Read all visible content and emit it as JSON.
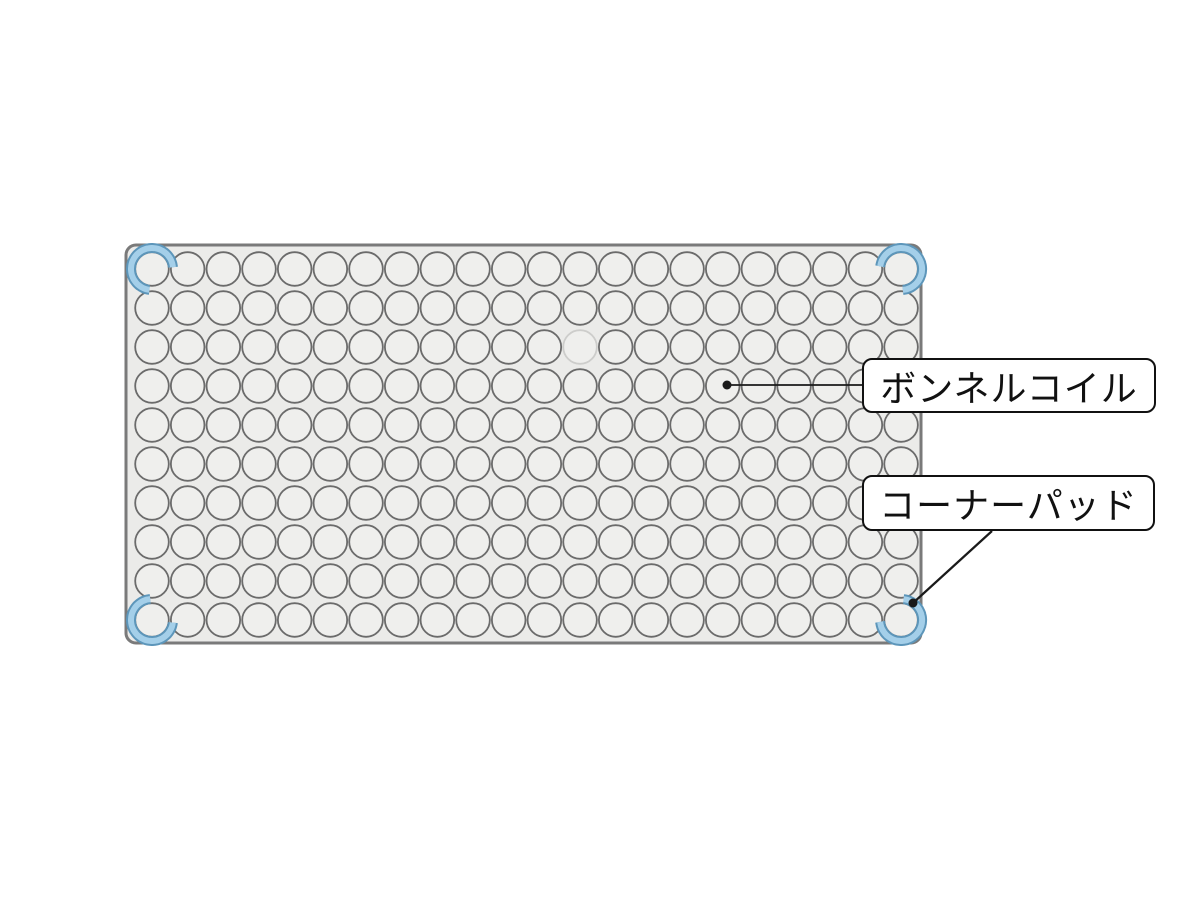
{
  "diagram": {
    "description": "mattress-bonnell-coil-structure-diagram",
    "mattress": {
      "x": 126,
      "y": 245,
      "width": 795,
      "height": 398,
      "corner_radius": 10,
      "fill": "#ebebe9",
      "stroke": "#7a7a7a",
      "stroke_width": 3
    },
    "coil_grid": {
      "rows": 10,
      "cols": 22,
      "start_x": 152,
      "start_y": 269,
      "pitch_x": 35.67,
      "pitch_y": 39,
      "radius": 16.8,
      "stroke": "#6b6b6b",
      "stroke_width": 1.8,
      "fill": "#efefed"
    },
    "faded_coil": {
      "row": 3,
      "col": 13,
      "stroke": "#cdcdcb"
    },
    "corner_pads": {
      "radius": 21,
      "outer_stroke": "#5d96ba",
      "outer_width": 10,
      "inner_stroke": "#a4cfe9",
      "inner_width": 6,
      "gap_half_deg": 50,
      "positions": [
        {
          "name": "top-left",
          "gap_center_deg": 315
        },
        {
          "name": "top-right",
          "gap_center_deg": 225
        },
        {
          "name": "bottom-left",
          "gap_center_deg": 45
        },
        {
          "name": "bottom-right",
          "gap_center_deg": 135
        }
      ]
    },
    "callouts": [
      {
        "id": "bonnell-coil",
        "text": "ボンネルコイル",
        "box": {
          "left": 862,
          "top": 358,
          "width": 294,
          "height": 55
        },
        "line": {
          "x1": 727,
          "y1": 385,
          "x2": 862,
          "y2": 385,
          "width": 1.8
        },
        "dot": {
          "x": 727,
          "y": 385,
          "r": 4.5
        }
      },
      {
        "id": "corner-pad",
        "text": "コーナーパッド",
        "box": {
          "left": 862,
          "top": 475,
          "width": 293,
          "height": 56
        },
        "line": {
          "x1": 992,
          "y1": 531,
          "x2": 913,
          "y2": 603,
          "width": 2.2
        },
        "dot": {
          "x": 913,
          "y": 603,
          "r": 4.5
        }
      }
    ],
    "line_color": "#1a1a1a"
  }
}
